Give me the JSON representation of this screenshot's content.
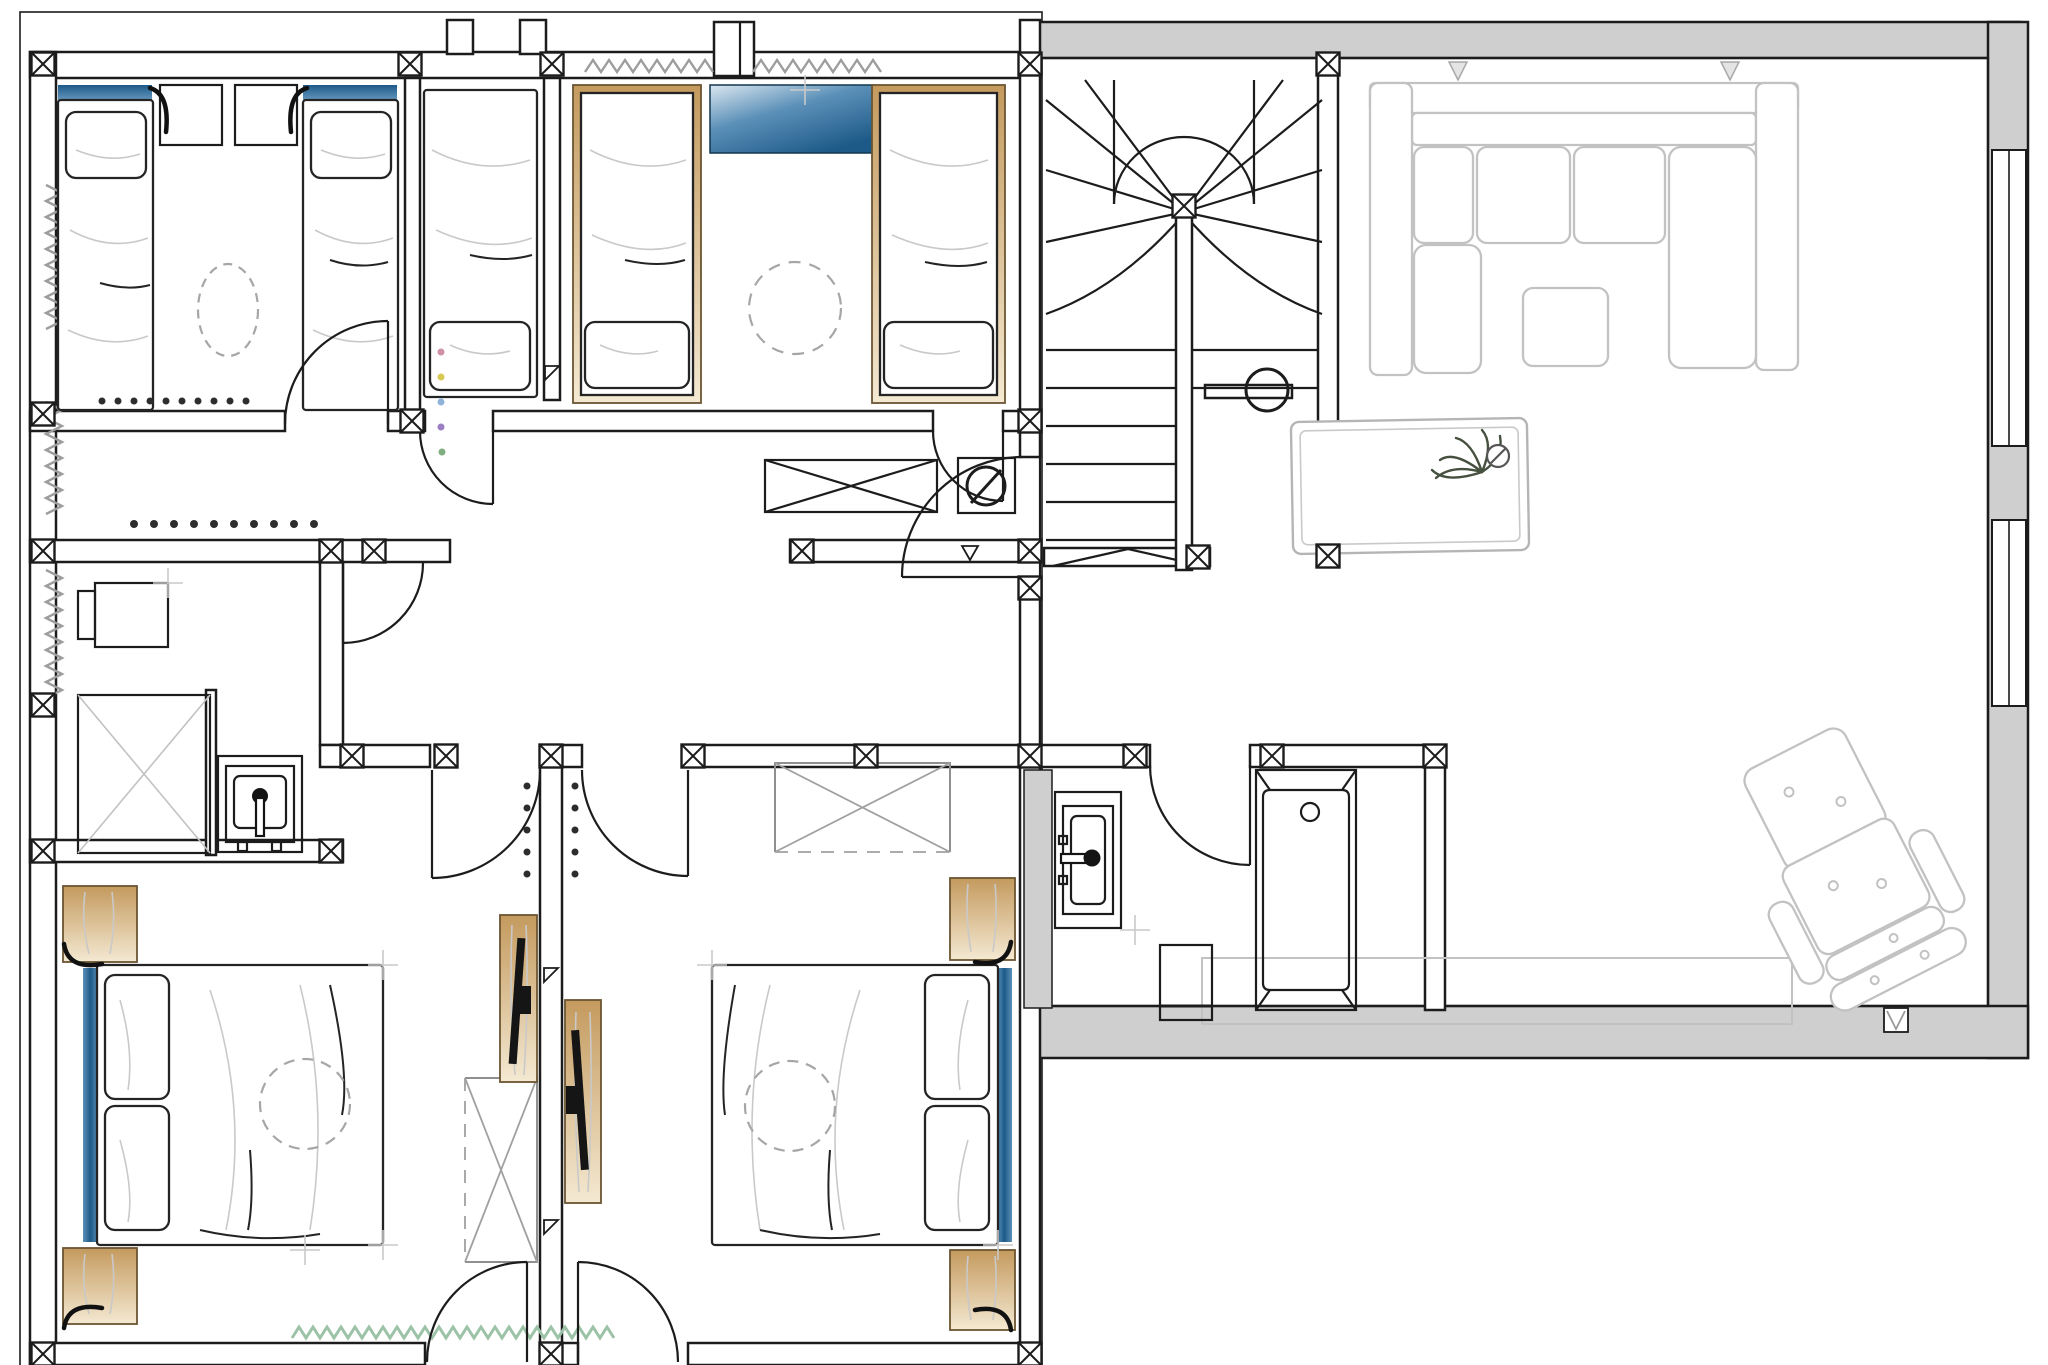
{
  "canvas": {
    "width": 2048,
    "height": 1365
  },
  "title": "upper-floor-plan-drawing",
  "colors": {
    "line": "#1c1c1c",
    "sketch": "#242424",
    "faint": "#c9c9c9",
    "furn": "#c2c2c2",
    "graywall": "#cfcfcf",
    "dashc": "#a6a6a6",
    "greenzig": "#9cc3a7",
    "grayzig": "#9d9d9d",
    "showerline": "#c2c2c2",
    "tanedge": "#6b5632",
    "tan_dark": "#c49a5e",
    "tan_light": "#f4e9d2",
    "blue_dark": "#1d5a88",
    "blue_mid": "#5b90b8",
    "blue_light": "#dbe7f0"
  },
  "rooms": [
    {
      "name": "kids-bedroom-1",
      "furniture": [
        "twin-bed",
        "twin-bed",
        "nightstand",
        "nightstand",
        "wall-lamp",
        "wall-lamp",
        "ceiling-light-dashed",
        "window-blue-strip",
        "window-blue-strip",
        "spot-row"
      ]
    },
    {
      "name": "kids-bedroom-2",
      "furniture": [
        "single-bed",
        "single-bed-wood-frame",
        "single-bed-wood-frame",
        "blue-chest",
        "ceiling-light-dashed"
      ]
    },
    {
      "name": "corridor",
      "furniture": [
        "crossed-table",
        "appliance-circle-slash",
        "wardrobe-spot-row",
        "signal-dots"
      ]
    },
    {
      "name": "utility-room",
      "furniture": [
        "desk",
        "chair",
        "shower-crossed",
        "washbasin"
      ]
    },
    {
      "name": "stair-hall",
      "furniture": [
        "winder-staircase",
        "newel-circle",
        "rug",
        "potted-plant"
      ]
    },
    {
      "name": "living-room",
      "furniture": [
        "sectional-sofa",
        "ottoman",
        "sideboard",
        "armchair",
        "footstool"
      ]
    },
    {
      "name": "bathroom",
      "furniture": [
        "washbasin",
        "waste-bin",
        "bathtub"
      ]
    },
    {
      "name": "bedroom-3",
      "furniture": [
        "double-bed",
        "pillow",
        "pillow",
        "nightstand",
        "nightstand",
        "wall-lamp",
        "wall-lamp",
        "wardrobe-crossed",
        "tv-sideboard",
        "ceiling-light-dashed",
        "radiator-zigzag",
        "headboard-blue-strip"
      ]
    },
    {
      "name": "bedroom-4",
      "furniture": [
        "double-bed",
        "pillow",
        "pillow",
        "nightstand",
        "nightstand",
        "wall-lamp",
        "wall-lamp",
        "wardrobe-crossed",
        "tv-sideboard",
        "ceiling-light-dashed",
        "headboard-blue-strip"
      ]
    }
  ]
}
